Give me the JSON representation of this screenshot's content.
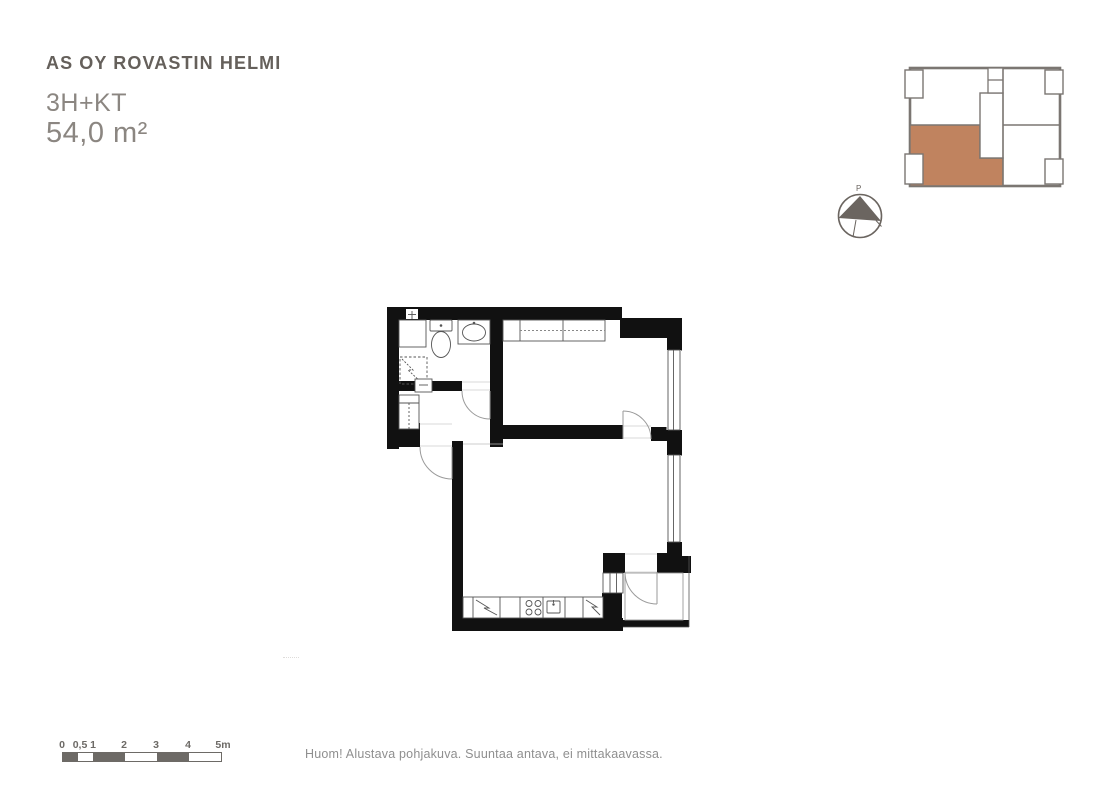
{
  "header": {
    "project_title": "AS OY ROVASTIN HELMI",
    "apartment_type": "3H+KT",
    "apartment_area": "54,0 m²"
  },
  "key_plan": {
    "highlight_color": "#c0835f",
    "outline_color": "#7b7672"
  },
  "compass": {
    "north_label": "P"
  },
  "floor_plan": {
    "wall_color": "#111111",
    "line_color": "#555555",
    "door_arc_color": "#9a9a9a",
    "fixtures": [
      "washer-space",
      "toilet",
      "washbasin",
      "shower-drain",
      "hall-wardrobe",
      "hall-cabinet",
      "bedroom-wardrobe",
      "refrigerator",
      "stove",
      "kitchen-sink",
      "dishwasher",
      "interior-window",
      "entry-door",
      "windows"
    ]
  },
  "scale_bar": {
    "labels": [
      "0",
      "0,5",
      "1",
      "2",
      "3",
      "4",
      "5m"
    ],
    "dark_color": "#6d6a66"
  },
  "footer": {
    "disclaimer": "Huom! Alustava pohjakuva. Suuntaa antava, ei mittakaavassa."
  }
}
